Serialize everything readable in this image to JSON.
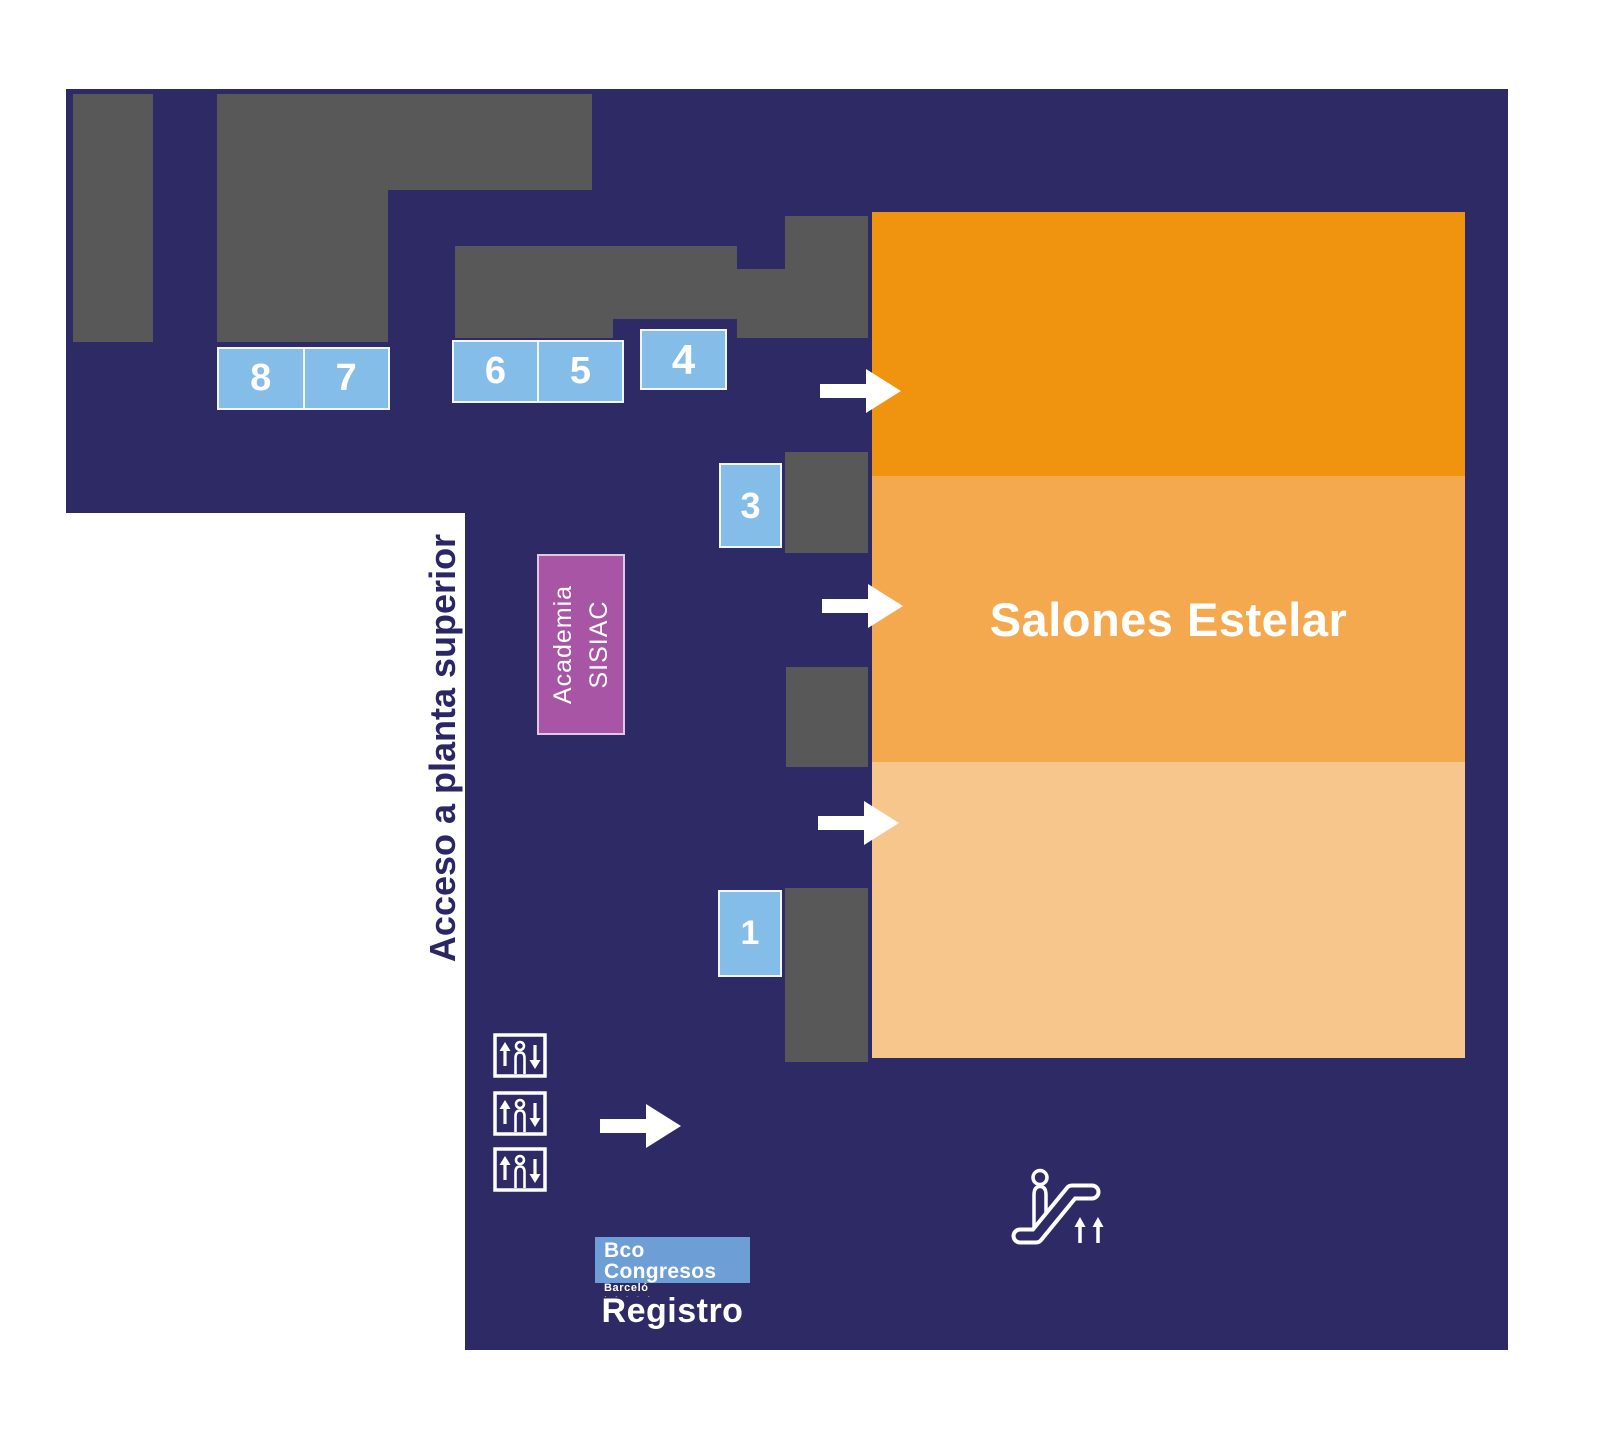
{
  "map": {
    "hall": {
      "name": "Salones Estelar"
    },
    "access_text": "Acceso a planta superior",
    "academia": {
      "line1": "Academia",
      "line2": "SISIAC"
    },
    "registro": "Registro",
    "logo": {
      "main": "Bco Congresos",
      "sub": "Barceló",
      "dots": "· · · · ·"
    },
    "booths": [
      {
        "label": "8"
      },
      {
        "label": "7"
      },
      {
        "label": "6"
      },
      {
        "label": "5"
      },
      {
        "label": "4"
      },
      {
        "label": "3"
      },
      {
        "label": "1"
      }
    ],
    "icons": {
      "elevator": "elevator-icon: square with up arrow, person, down arrow",
      "escalator": "escalator-icon: person on up escalator with two up arrows",
      "direction": "right-arrow-icon: →"
    }
  },
  "colors": {
    "navy": "#2d2a66",
    "room_gray": "#595859",
    "hall_orange_dark": "#f0930e",
    "hall_orange_mid": "#f4a94f",
    "hall_orange_light": "#f7c68c",
    "booth_blue": "#85bde9",
    "logo_blue": "#6d9ed6",
    "academia_purple": "#a855a5",
    "academia_border": "#e2c6e2",
    "access_text": "#2b2767"
  }
}
